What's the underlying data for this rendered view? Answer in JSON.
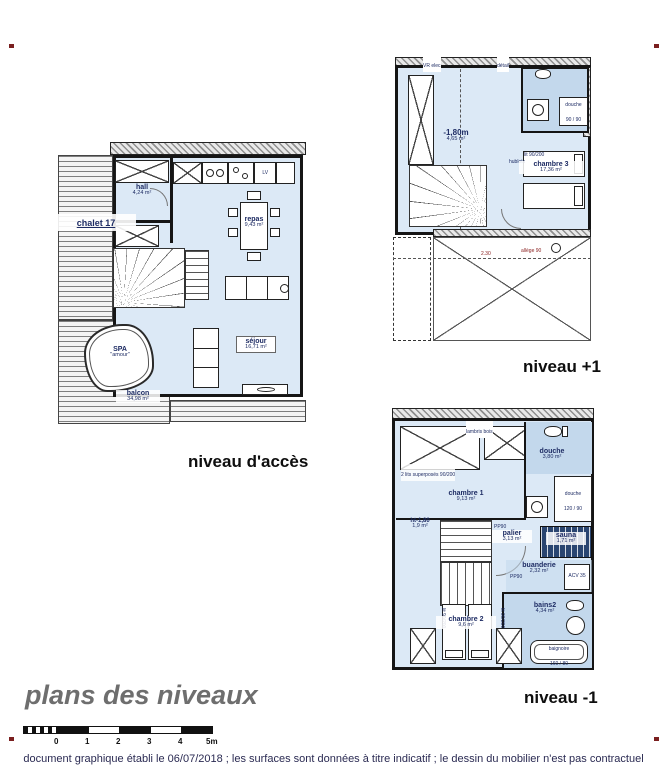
{
  "colors": {
    "floor_blue": "#dce9f6",
    "wet_blue": "#c3d8ec",
    "sauna_navy": "#2a4570",
    "wall_black": "#151515",
    "label_navy": "#1d2b63",
    "dimension_red": "#8a2020",
    "title_gray": "#6e6e6e",
    "footer_navy": "#2a2a52",
    "registration_mark_red": "#7a1f1f"
  },
  "title": {
    "text": "plans des niveaux"
  },
  "footer": {
    "text": "document graphique établi le 06/07/2018 ; les surfaces sont données à titre indicatif ; le dessin du mobilier n'est pas contractuel"
  },
  "scalebar": {
    "ticks": [
      "0",
      "1",
      "2",
      "3",
      "4",
      "5m"
    ]
  },
  "plans": {
    "acces": {
      "label": "niveau d'accès",
      "chalet": "chalet 17",
      "kitchen": {
        "lv": "LV"
      },
      "rooms": {
        "hall": {
          "name": "hall",
          "area": "4,24 m²"
        },
        "repas": {
          "name": "repas",
          "area": "9,43 m²"
        },
        "sejour": {
          "name": "séjour",
          "area": "16,71 m²"
        },
        "spa": {
          "name": "SPA",
          "sub": "\"amour\""
        },
        "balcon": {
          "name": "balcon",
          "area": "34,98 m²"
        }
      }
    },
    "plus1": {
      "label": "niveau +1",
      "rooms": {
        "low": {
          "name": "-1,80m",
          "area": "4,65 m²"
        },
        "chambre3": {
          "name": "chambre 3",
          "area": "17,36 m²"
        },
        "douche": {
          "name": "douche",
          "area": "90 / 90"
        }
      },
      "notes": {
        "vr": "VR elec",
        "detail": "détail",
        "hublots": "hublots",
        "allege": "allège 90",
        "dim": "2.30",
        "lit": "lit 90/200"
      }
    },
    "moins1": {
      "label": "niveau -1",
      "rooms": {
        "chambre1": {
          "name": "chambre 1",
          "area": "9,13 m²"
        },
        "douche": {
          "name": "douche",
          "area": "3,80 m²"
        },
        "cabine": {
          "name": "douche",
          "area": "120 / 90"
        },
        "palier": {
          "name": "palier",
          "area": "3,13 m²"
        },
        "sauna": {
          "name": "sauna",
          "area": "1,71 m²"
        },
        "buanderie": {
          "name": "buanderie",
          "area": "2,32 m²"
        },
        "bains2": {
          "name": "bains2",
          "area": "4,34 m²"
        },
        "chambre2": {
          "name": "chambre 2",
          "area": "9,6 m²"
        },
        "baignoire": {
          "name": "baignoire",
          "area": "160 / 80"
        },
        "ht": {
          "name": "ht-1,80",
          "area": "1,9 m²"
        }
      },
      "notes": {
        "bunk": "2 lits superposés 90/200",
        "lambris": "lambris bois",
        "acv": "ACV 35",
        "pp90": "PP90",
        "lit": "lit 90/200"
      }
    }
  }
}
